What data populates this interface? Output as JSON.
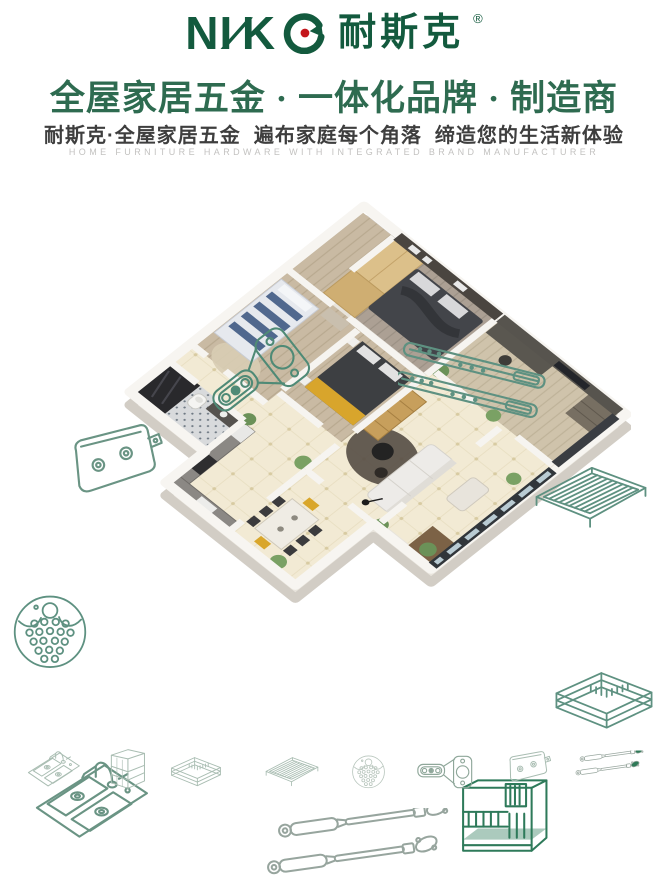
{
  "brand": {
    "logo_latin_a": "NI",
    "logo_s": "∕",
    "logo_latin_b": "K",
    "logo_cn": "耐斯克",
    "registered": "®"
  },
  "header": {
    "headline": "全屋家居五金 · 一体化品牌 · 制造商",
    "subheadline": "耐斯克·全屋家居五金  遍布家庭每个角落  缔造您的生活新体验",
    "tagline_en": "HOME FURNITURE HARDWARE WITH INTEGRATED BRAND MANUFACTURER"
  },
  "colors": {
    "brand_green": "#135a3e",
    "headline_green": "#2e6b50",
    "accent_red": "#c4161c",
    "line_art_teal": "#5e9181",
    "line_art_dark_green": "#2e7a5a",
    "line_art_faint": "#a9bdb2",
    "subheadline_gray": "#3e3e3e",
    "tagline_gray": "#c3c2c0"
  },
  "scene": {
    "description": "isometric cutaway 3D render of a furnished apartment floor plan",
    "rooms": [
      "master-bedroom",
      "study",
      "balcony",
      "kids-room",
      "second-bedroom",
      "living-room",
      "dining-area",
      "bathroom",
      "kitchen"
    ]
  },
  "hardware_icons": [
    {
      "id": "cabinet-hinge",
      "label": "concealed cabinet hinge"
    },
    {
      "id": "drawer-slides",
      "label": "ball-bearing drawer slides"
    },
    {
      "id": "glass-clamp",
      "label": "glass panel clamp"
    },
    {
      "id": "perforated-disc",
      "label": "perforated strainer plate"
    },
    {
      "id": "wire-shelf",
      "label": "wire shelf rack"
    },
    {
      "id": "wire-basket",
      "label": "pull-out wire basket"
    },
    {
      "id": "kitchen-sink",
      "label": "double-bowl kitchen sink with faucet"
    },
    {
      "id": "gas-struts",
      "label": "gas lift struts"
    },
    {
      "id": "dish-rack",
      "label": "countertop kitchen organizer rack"
    }
  ],
  "bottom_row": [
    "kitchen-sink",
    "cabinet-organizer",
    "wire-basket",
    "wire-shelf",
    "perforated-disc",
    "cabinet-hinge",
    "glass-clamp",
    "gas-struts"
  ]
}
